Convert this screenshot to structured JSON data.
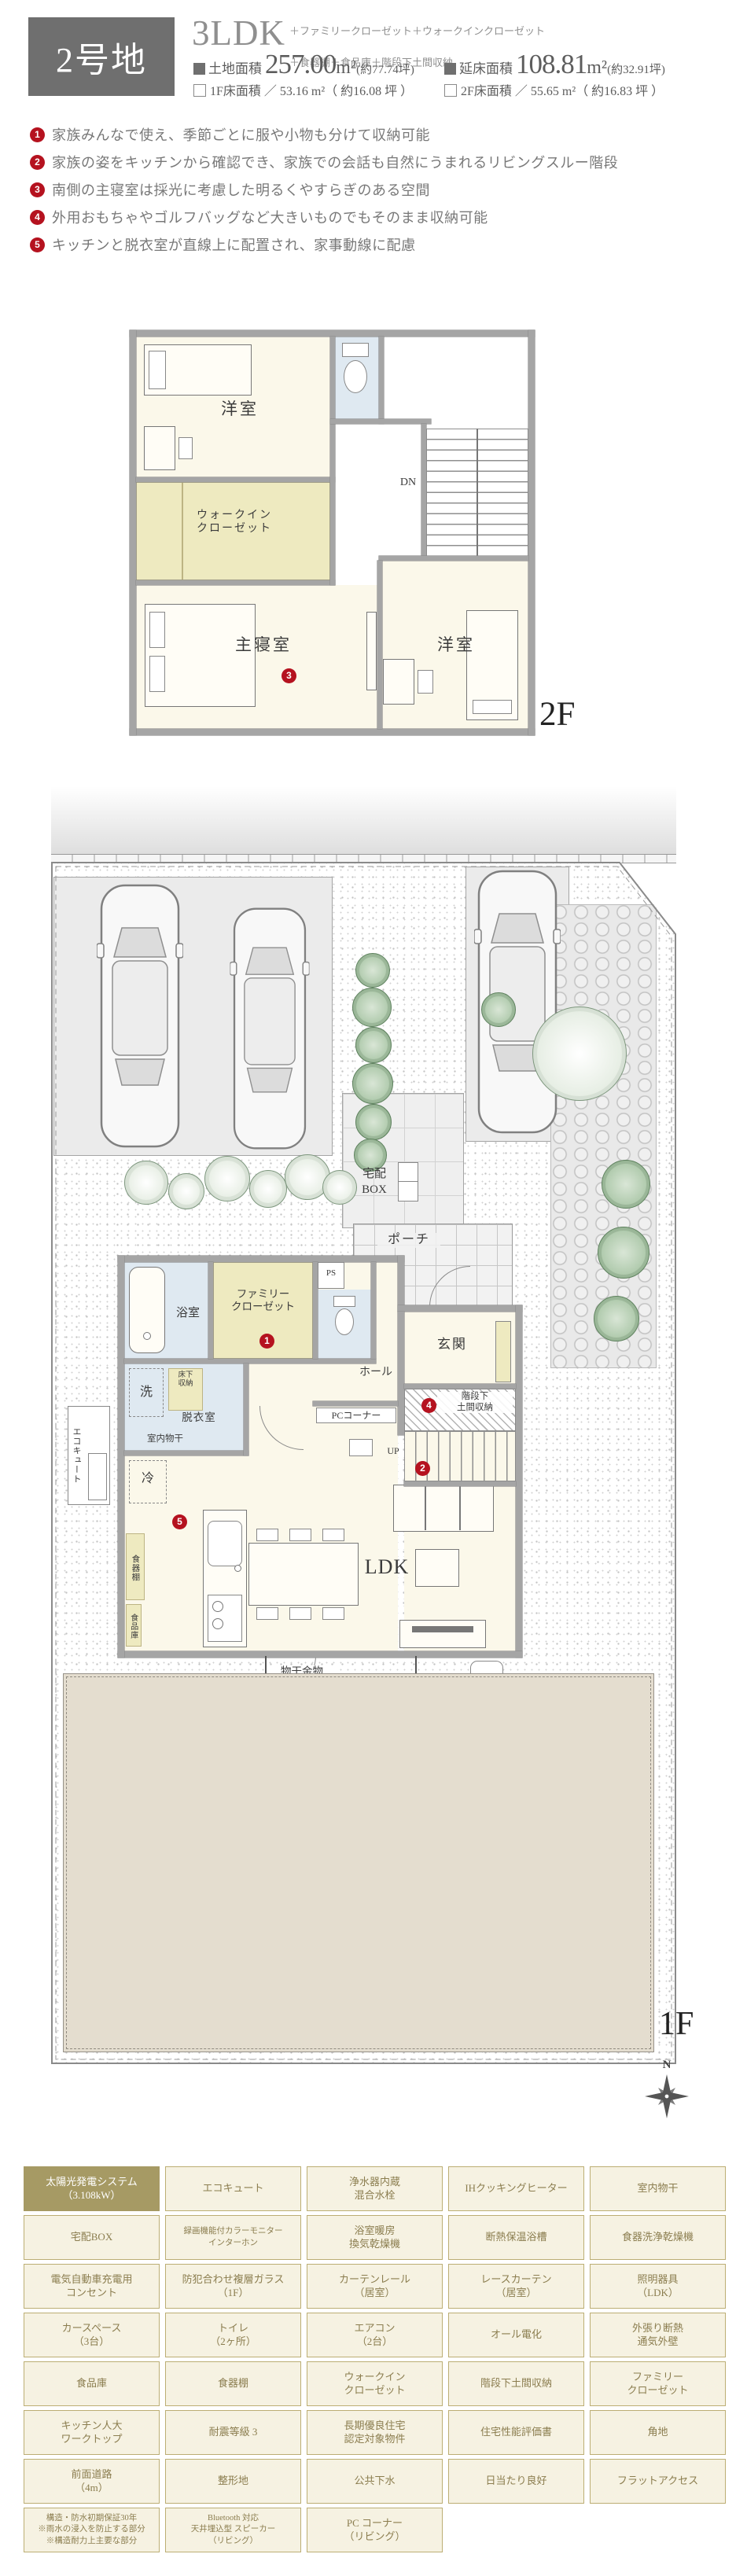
{
  "colors": {
    "accent_red": "#b5121f",
    "lot_box_gray": "#6f6f6f",
    "wall_gray": "#a5a5a5",
    "room_cream": "#fbf8ea",
    "closet_yellow": "#eeeac0",
    "wet_blue": "#dfe9f1",
    "garden_beige": "#e4ddcf",
    "table_highlight": "#a69a64"
  },
  "header": {
    "lot_number": "2号地",
    "plan_type": "3LDK",
    "plan_options_line1": "＋ファミリークローゼット＋ウォークインクローゼット",
    "plan_options_line2": "＋食器棚＋食品庫＋階段下土間収納",
    "land_area_label": "土地面積",
    "land_area_value": "257.00",
    "land_area_unit": "m²",
    "land_area_tsubo": "(約77.74坪)",
    "total_floor_label": "延床面積",
    "total_floor_value": "108.81",
    "total_floor_unit": "m²",
    "total_floor_tsubo": "(約32.91坪)",
    "floor1_line": "1F床面積 ／ 53.16 m²（ 約16.08 坪 ）",
    "floor2_line": "2F床面積 ／ 55.65 m²（ 約16.83 坪 ）"
  },
  "features": [
    {
      "num": "1",
      "text": "家族みんなで使え、季節ごとに服や小物も分けて収納可能"
    },
    {
      "num": "2",
      "text": "家族の姿をキッチンから確認でき、家族での会話も自然にうまれるリビングスルー階段"
    },
    {
      "num": "3",
      "text": "南側の主寝室は採光に考慮した明るくやすらぎのある空間"
    },
    {
      "num": "4",
      "text": "外用おもちゃやゴルフバッグなど大きいものでもそのまま収納可能"
    },
    {
      "num": "5",
      "text": "キッチンと脱衣室が直線上に配置され、家事動線に配慮"
    }
  ],
  "plan2f": {
    "floor_label": "2F",
    "dn": "DN",
    "room_yoshitsu_top": "洋室",
    "room_wic": "ウォークイン\nクローゼット",
    "room_shusin": "主寝室",
    "room_yoshitsu_bottom": "洋室",
    "marker_3": "3"
  },
  "plan1f": {
    "floor_label": "1F",
    "road": "道路",
    "delivery_box": "宅配\nBOX",
    "porch": "ポーチ",
    "bath": "浴室",
    "family_closet": "ファミリー\nクローゼット",
    "ps": "PS",
    "genkan": "玄関",
    "wash": "洗",
    "floor_storage": "床下\n収納",
    "datsuishitsu": "脱衣室",
    "indoor_drying": "室内物干",
    "ecocute": "エコキュート",
    "hall": "ホール",
    "pc_corner": "PCコーナー",
    "up": "UP",
    "stair_storage": "階段下\n土間収納",
    "fridge": "冷",
    "cupboard": "食器棚",
    "pantry": "食品庫",
    "ldk": "LDK",
    "drying_hardware": "物干金物",
    "marker_1": "1",
    "marker_2": "2",
    "marker_4": "4",
    "marker_5": "5",
    "compass_n": "N"
  },
  "equipment_table": {
    "rows": [
      [
        "太陽光発電システム\n（3.108kW）",
        "エコキュート",
        "浄水器内蔵\n混合水栓",
        "IHクッキングヒーター",
        "室内物干"
      ],
      [
        "宅配BOX",
        "録画機能付カラーモニター\nインターホン",
        "浴室暖房\n換気乾燥機",
        "断熱保温浴槽",
        "食器洗浄乾燥機"
      ],
      [
        "電気自動車充電用\nコンセント",
        "防犯合わせ複層ガラス\n（1F）",
        "カーテンレール\n（居室）",
        "レースカーテン\n（居室）",
        "照明器具\n（LDK）"
      ],
      [
        "カースペース\n（3台）",
        "トイレ\n（2ヶ所）",
        "エアコン\n（2台）",
        "オール電化",
        "外張り断熱\n通気外壁"
      ],
      [
        "食品庫",
        "食器棚",
        "ウォークイン\nクローゼット",
        "階段下土間収納",
        "ファミリー\nクローゼット"
      ],
      [
        "キッチン人大\nワークトップ",
        "耐震等級 3",
        "長期優良住宅\n認定対象物件",
        "住宅性能評価書",
        "角地"
      ],
      [
        "前面道路\n（4m）",
        "整形地",
        "公共下水",
        "日当たり良好",
        "フラットアクセス"
      ],
      [
        "構造・防水初期保証30年\n※雨水の浸入を防止する部分\n※構造耐力上主要な部分",
        "Bluetooth 対応\n天井埋込型 スピーカー\n（リビング）",
        "PC コーナー\n（リビング）"
      ]
    ]
  }
}
